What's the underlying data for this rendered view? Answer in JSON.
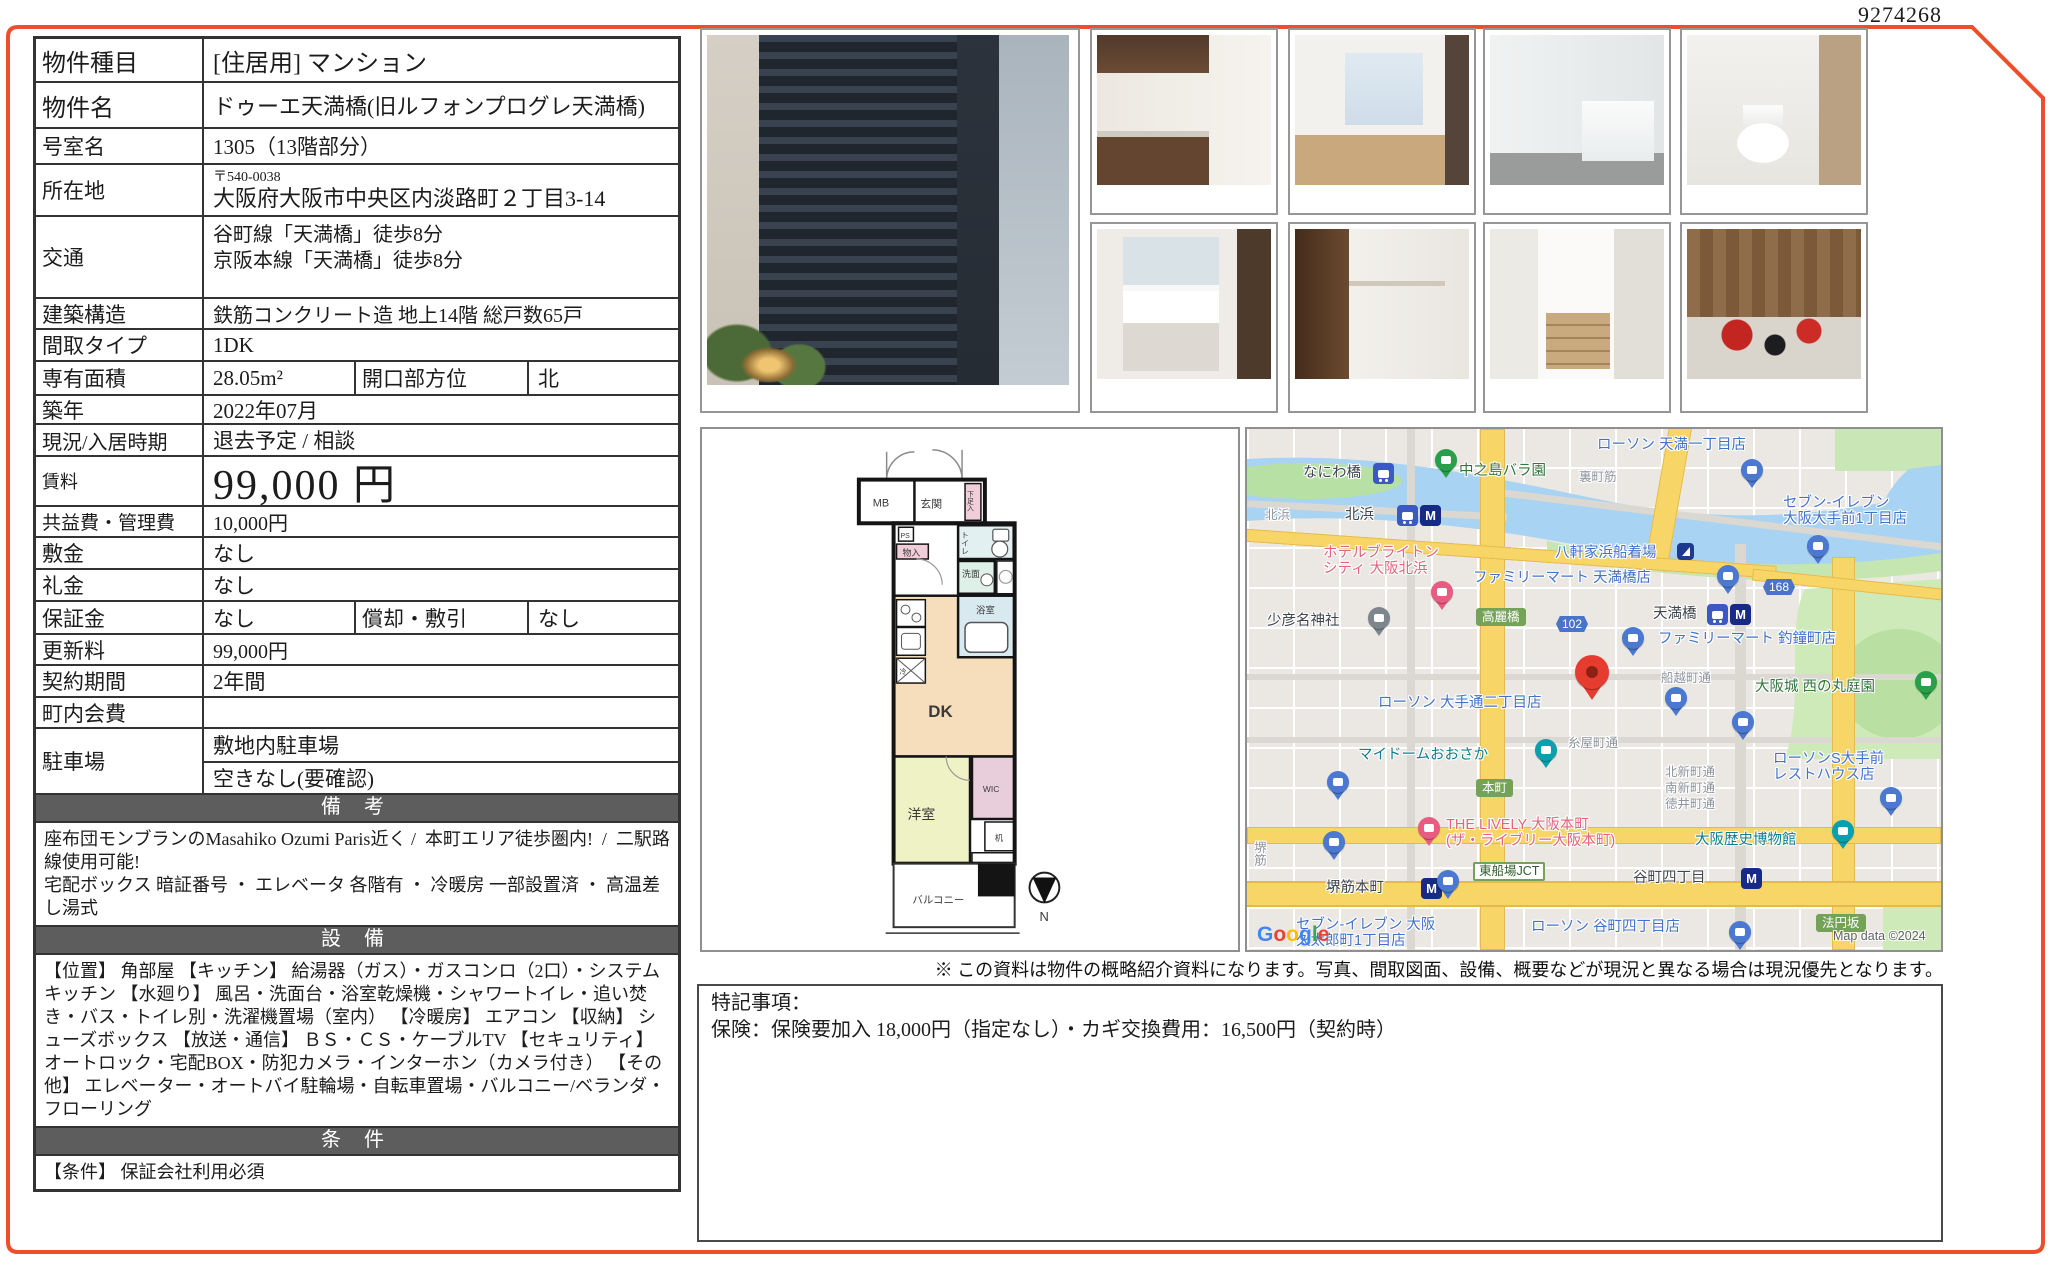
{
  "page": {
    "doc_number": "9274268",
    "accent_border_color": "#ee4e2b",
    "disclaimer": "※ この資料は物件の概略紹介資料になります。写真、間取図面、設備、概要などが現況と異なる場合は現況優先となります。"
  },
  "table": {
    "property_type": {
      "label": "物件種目",
      "value": "[住居用]  マンション"
    },
    "property_name": {
      "label": "物件名",
      "value": "ドゥーエ天満橋(旧ルフォンプログレ天満橋)"
    },
    "room_no": {
      "label": "号室名",
      "value": "1305（13階部分）"
    },
    "address": {
      "label": "所在地",
      "postal": "〒540-0038",
      "value": "大阪府大阪市中央区内淡路町２丁目3-14"
    },
    "access": {
      "label": "交通",
      "line1": "谷町線「天満橋」徒歩8分",
      "line2": "京阪本線「天満橋」徒歩8分"
    },
    "structure": {
      "label": "建築構造",
      "value": "鉄筋コンクリート造 地上14階 総戸数65戸"
    },
    "layout_type": {
      "label": "間取タイプ",
      "value": "1DK"
    },
    "area": {
      "label": "専有面積",
      "value": "28.05m²",
      "label2": "開口部方位",
      "value2": "北"
    },
    "built": {
      "label": "築年",
      "value": "2022年07月"
    },
    "status": {
      "label": "現況/入居時期",
      "value": "退去予定 /  相談"
    },
    "rent": {
      "label": "賃料",
      "value": "99,000 円"
    },
    "fees": {
      "label": "共益費・管理費",
      "value": "10,000円"
    },
    "deposit": {
      "label": "敷金",
      "value": "なし"
    },
    "key_money": {
      "label": "礼金",
      "value": "なし"
    },
    "guarantee": {
      "label": "保証金",
      "value": "なし",
      "label2": "償却・敷引",
      "value2": "なし"
    },
    "renewal_fee": {
      "label": "更新料",
      "value": "99,000円"
    },
    "contract_term": {
      "label": "契約期間",
      "value": "2年間"
    },
    "town_fee": {
      "label": "町内会費",
      "value": ""
    },
    "parking": {
      "label": "駐車場",
      "value1": "敷地内駐車場",
      "value2": "空きなし(要確認)"
    },
    "remarks": {
      "header": "備 考",
      "text": "座布団モンブランのMasahiko Ozumi Paris近く /  本町エリア徒歩圏内!  /  二駅路線使用可能!\n宅配ボックス 暗証番号 ・ エレベータ 各階有 ・ 冷暖房 一部設置済 ・ 高温差し湯式"
    },
    "equipment": {
      "header": "設 備",
      "text": "【位置】 角部屋 【キッチン】 給湯器（ガス）・ガスコンロ（2口）・システムキッチン 【水廻り】 風呂・洗面台・浴室乾燥機・シャワートイレ・追い焚き・バス・トイレ別・洗濯機置場（室内） 【冷暖房】 エアコン 【収納】 シューズボックス 【放送・通信】 ＢＳ・ＣＳ・ケーブルTV 【セキュリティ】 オートロック・宅配BOX・防犯カメラ・インターホン（カメラ付き） 【その他】 エレベーター・オートバイ駐輪場・自転車置場・バルコニー/ベランダ・フローリング"
    },
    "conditions": {
      "header": "条 件",
      "text": "【条件】 保証会社利用必須"
    }
  },
  "photos": {
    "main": "building-exterior-photo",
    "thumbs": [
      "kitchen-photo",
      "room-photo",
      "bathroom-photo",
      "toilet-photo",
      "washbasin-photo",
      "closet-photo",
      "entrance-steps-photo",
      "lounge-photo"
    ]
  },
  "floorplan": {
    "mb": "MB",
    "entrance": "玄関",
    "shoebox": "下足入",
    "ps": "PS",
    "storage": "物入",
    "toilet": "トイレ",
    "washroom": "洗面",
    "bath": "浴室",
    "dk": "DK",
    "fridge": "冷",
    "bedroom": "洋室",
    "wic": "WIC",
    "desk": "机",
    "balcony": "バルコニー",
    "north": "N"
  },
  "notes_box": {
    "title": "特記事項：",
    "body": "保険：保険要加入 18,000円（指定なし）・カギ交換費用：16,500円（契約時）"
  },
  "map": {
    "google": "Google",
    "attribution": "Map data ©2024",
    "labels": [
      {
        "text": "ローソン 天満一丁目店",
        "type": "shop",
        "x": 350,
        "y": 8
      },
      {
        "text": "なにわ橋",
        "type": "transit",
        "x": 56,
        "y": 36
      },
      {
        "text": "中之島バラ園",
        "type": "park",
        "x": 212,
        "y": 34
      },
      {
        "text": "裏町筋",
        "type": "street",
        "x": 332,
        "y": 40
      },
      {
        "text": "セブン-イレブン\n大阪大手前1丁目店",
        "type": "shop",
        "x": 536,
        "y": 66
      },
      {
        "text": "北浜",
        "type": "street",
        "x": 18,
        "y": 78
      },
      {
        "text": "北浜",
        "type": "transit",
        "x": 98,
        "y": 78
      },
      {
        "text": "八軒家浜船着場",
        "type": "shop",
        "x": 308,
        "y": 116
      },
      {
        "text": "ホテルブライトン\nシティ 大阪北浜",
        "type": "hotel",
        "x": 76,
        "y": 116
      },
      {
        "text": "ファミリーマート 天満橋店",
        "type": "shop",
        "x": 226,
        "y": 141
      },
      {
        "text": "168",
        "type": "shield",
        "x": 516,
        "y": 150
      },
      {
        "text": "少彦名神社",
        "type": "transit",
        "x": 20,
        "y": 184
      },
      {
        "text": "高麗橋",
        "type": "chip",
        "x": 229,
        "y": 179
      },
      {
        "text": "102",
        "type": "shield",
        "x": 309,
        "y": 187
      },
      {
        "text": "天満橋",
        "type": "transit",
        "x": 406,
        "y": 177
      },
      {
        "text": "ファミリーマート 釣鐘町店",
        "type": "shop",
        "x": 411,
        "y": 202
      },
      {
        "text": "船越町通",
        "type": "street",
        "x": 414,
        "y": 241
      },
      {
        "text": "大阪城 西の丸庭園",
        "type": "park",
        "x": 508,
        "y": 250
      },
      {
        "text": "ローソン 大手通二丁目店",
        "type": "shop",
        "x": 131,
        "y": 266
      },
      {
        "text": "糸屋町通",
        "type": "street",
        "x": 321,
        "y": 306
      },
      {
        "text": "マイドームおおさか",
        "type": "civic",
        "x": 111,
        "y": 318
      },
      {
        "text": "ローソンS大手前\nレストハウス店",
        "type": "shop",
        "x": 526,
        "y": 322
      },
      {
        "text": "本町",
        "type": "chip",
        "x": 229,
        "y": 350
      },
      {
        "text": "北新町通",
        "type": "street",
        "x": 418,
        "y": 335
      },
      {
        "text": "南新町通",
        "type": "street",
        "x": 418,
        "y": 351
      },
      {
        "text": "徳井町通",
        "type": "street",
        "x": 418,
        "y": 367
      },
      {
        "text": "THE LIVELY 大阪本町\n(ザ・ライブリー大阪本町)",
        "type": "hotel",
        "x": 199,
        "y": 388
      },
      {
        "text": "東船場JCT",
        "type": "chipo",
        "x": 226,
        "y": 433
      },
      {
        "text": "大阪歴史博物館",
        "type": "civic",
        "x": 448,
        "y": 403
      },
      {
        "text": "堺筋本町",
        "type": "transit",
        "x": 79,
        "y": 451
      },
      {
        "text": "谷町四丁目",
        "type": "transit",
        "x": 386,
        "y": 441
      },
      {
        "text": "セブン-イレブン 大阪\n久太郎町1丁目店",
        "type": "shop",
        "x": 49,
        "y": 488
      },
      {
        "text": "ローソン 谷町四丁目店",
        "type": "shop",
        "x": 284,
        "y": 490
      },
      {
        "text": "法円坂",
        "type": "chip",
        "x": 569,
        "y": 485
      },
      {
        "text": "堺筋",
        "type": "streetv",
        "x": 4,
        "y": 412
      }
    ],
    "pins": [
      {
        "kind": "conv",
        "x": 492,
        "y": 30
      },
      {
        "kind": "train",
        "x": 126,
        "y": 34
      },
      {
        "kind": "park",
        "x": 186,
        "y": 20
      },
      {
        "kind": "train",
        "x": 150,
        "y": 76
      },
      {
        "kind": "metro",
        "x": 173,
        "y": 76
      },
      {
        "kind": "anchor",
        "x": 430,
        "y": 114
      },
      {
        "kind": "hotel",
        "x": 182,
        "y": 152
      },
      {
        "kind": "conv",
        "x": 468,
        "y": 136
      },
      {
        "kind": "shrine",
        "x": 119,
        "y": 178
      },
      {
        "kind": "train",
        "x": 460,
        "y": 175
      },
      {
        "kind": "metro",
        "x": 483,
        "y": 175
      },
      {
        "kind": "conv",
        "x": 373,
        "y": 198
      },
      {
        "kind": "conv",
        "x": 558,
        "y": 106
      },
      {
        "kind": "park",
        "x": 666,
        "y": 242
      },
      {
        "kind": "dest",
        "x": 326,
        "y": 226
      },
      {
        "kind": "conv",
        "x": 416,
        "y": 258
      },
      {
        "kind": "conv",
        "x": 483,
        "y": 282
      },
      {
        "kind": "civic",
        "x": 286,
        "y": 310
      },
      {
        "kind": "conv",
        "x": 78,
        "y": 342
      },
      {
        "kind": "conv",
        "x": 74,
        "y": 402
      },
      {
        "kind": "hotel",
        "x": 169,
        "y": 388
      },
      {
        "kind": "conv",
        "x": 631,
        "y": 358
      },
      {
        "kind": "civic",
        "x": 583,
        "y": 391
      },
      {
        "kind": "metro",
        "x": 174,
        "y": 449
      },
      {
        "kind": "metro",
        "x": 494,
        "y": 439
      },
      {
        "kind": "conv",
        "x": 188,
        "y": 441
      },
      {
        "kind": "conv",
        "x": 480,
        "y": 492
      }
    ]
  }
}
